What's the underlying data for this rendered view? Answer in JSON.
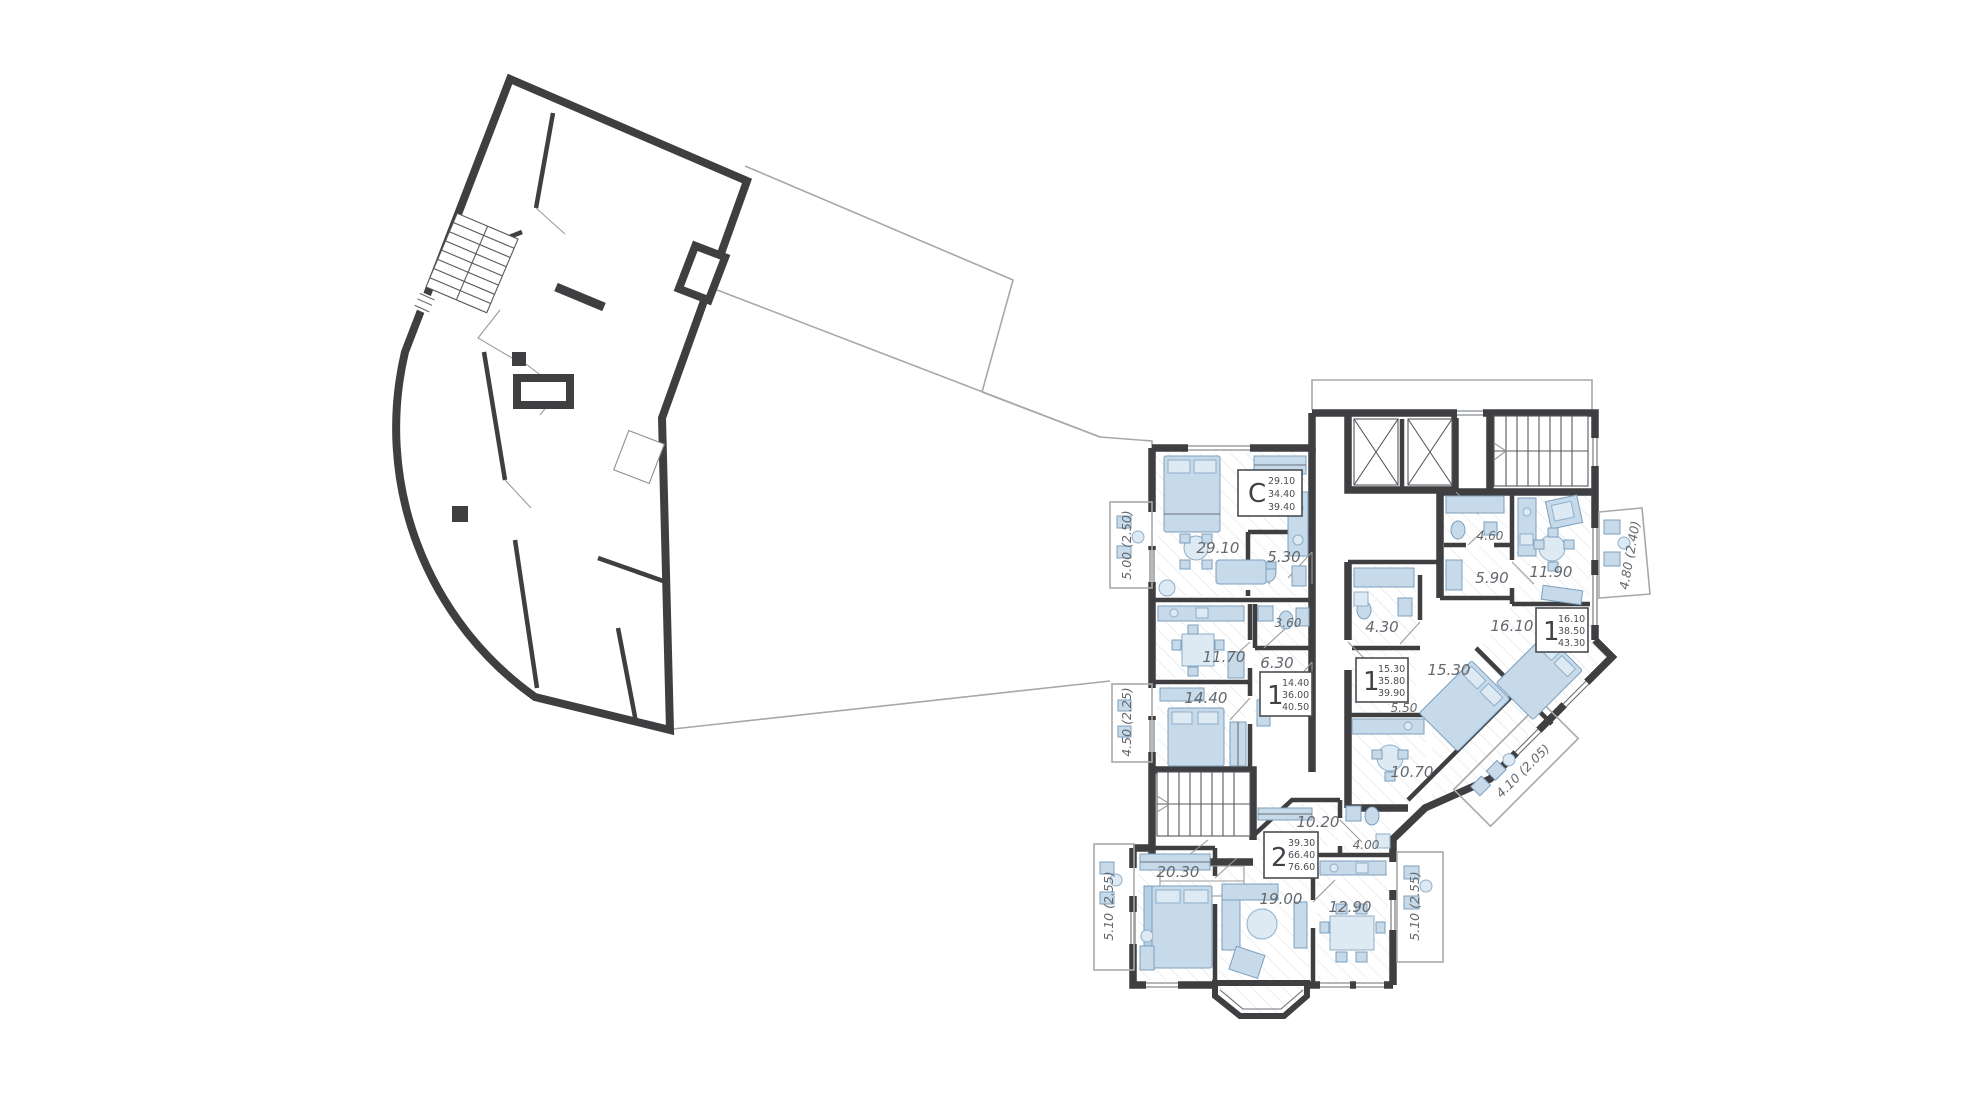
{
  "plan": {
    "units": {
      "studio": {
        "type": "C",
        "areas": [
          "29.10",
          "34.40",
          "39.40"
        ]
      },
      "apt1a": {
        "type": "1",
        "areas": [
          "14.40",
          "36.00",
          "40.50"
        ]
      },
      "apt1b": {
        "type": "1",
        "areas": [
          "15.30",
          "35.80",
          "39.90"
        ]
      },
      "apt1c": {
        "type": "1",
        "areas": [
          "16.10",
          "38.50",
          "43.30"
        ]
      },
      "apt2": {
        "type": "2",
        "areas": [
          "39.30",
          "66.40",
          "76.60"
        ]
      }
    },
    "rooms": {
      "studio_living": "29.10",
      "studio_bath": "5.30",
      "apt1a_kitchen": "11.70",
      "apt1a_hall": "6.30",
      "apt1a_bath": "3.60",
      "apt1a_bedroom": "14.40",
      "apt1b_bath": "4.30",
      "apt1b_living": "15.30",
      "apt1b_hall": "5.50",
      "apt1b_kitchen": "10.70",
      "apt1c_hall": "5.90",
      "apt1c_bath": "4.60",
      "apt1c_kitchen": "11.90",
      "apt1c_bedroom": "16.10",
      "apt2_corridor": "10.20",
      "apt2_bath": "4.00",
      "apt2_bedroom": "20.30",
      "apt2_living": "19.00",
      "apt2_kitchen": "12.90"
    },
    "balconies": {
      "studio": "5.00 (2.50)",
      "apt1a": "4.50 (2.25)",
      "apt1b": "4.10 (2.05)",
      "apt1c": "4.80 (2.40)",
      "apt2_left": "5.10 (2.55)",
      "apt2_right": "5.10 (2.55)"
    },
    "colors": {
      "wall": "#3f3f41",
      "furniture": "#c6daea",
      "furniture_stroke": "#7d9fbd",
      "floor_hatch": "#e3e7ea",
      "outline": "#a8a8a8",
      "label_text": "#64686d"
    }
  }
}
